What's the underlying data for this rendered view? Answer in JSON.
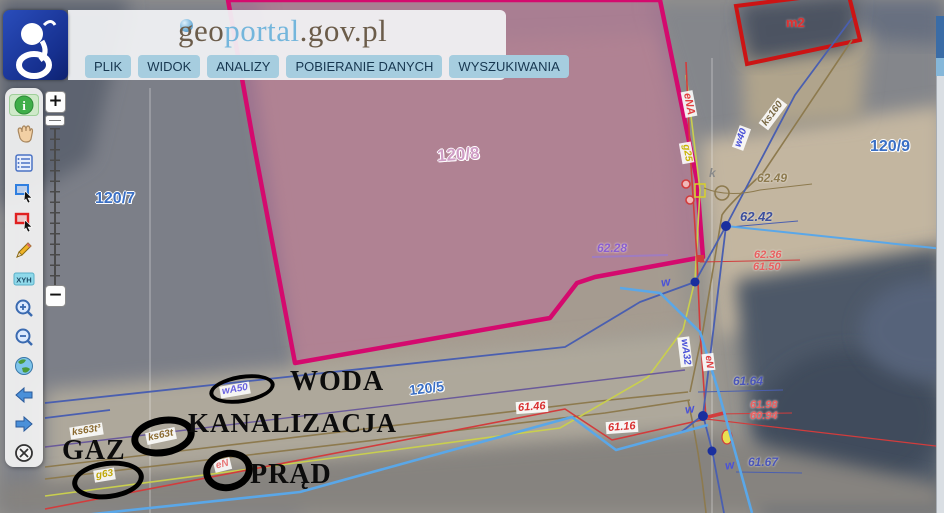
{
  "header": {
    "site_title": {
      "geo": "geo",
      "portal": "portal",
      "suffix": ".gov.pl"
    },
    "menu": [
      {
        "label": "PLIK"
      },
      {
        "label": "WIDOK"
      },
      {
        "label": "ANALIZY"
      },
      {
        "label": "POBIERANIE DANYCH"
      },
      {
        "label": "WYSZUKIWANIA"
      }
    ]
  },
  "toolbar": {
    "items": [
      {
        "name": "identify",
        "glyph": "i",
        "selected": true
      },
      {
        "name": "pan-hand"
      },
      {
        "name": "attributes-table"
      },
      {
        "name": "select-area-blue"
      },
      {
        "name": "select-area-red"
      },
      {
        "name": "draw-pencil"
      },
      {
        "name": "coordinates-xyh",
        "glyph": "XYH"
      },
      {
        "name": "zoom-in"
      },
      {
        "name": "zoom-out"
      },
      {
        "name": "full-extent-globe"
      },
      {
        "name": "previous-view"
      },
      {
        "name": "next-view"
      },
      {
        "name": "move-map"
      }
    ]
  },
  "zoom_control": {
    "plus": "+",
    "minus": "−"
  },
  "map": {
    "parcel_labels": {
      "p1207": "120/7",
      "p1208": "120/8",
      "p1209": "120/9",
      "p1205": "120/5"
    },
    "building_label": "m2",
    "utility_labels": {
      "wa50": "wA50",
      "ks63t3": "ks63t³",
      "ks63t": "ks63t",
      "g63": "g63",
      "en_road": "eN",
      "ena": "eNA",
      "g25": "g25",
      "w40": "w40",
      "ks160": "ks160",
      "wa32": "wA32",
      "en_riser": "eN",
      "w1": "w",
      "w2": "w",
      "w3": "w",
      "k1": "k"
    },
    "elevations": {
      "e6249": "62.49",
      "e6242": "62.42",
      "e6236": "62.36",
      "e6150": "61.50",
      "e6228": "62.28",
      "e6164": "61.64",
      "e6198": "61.98",
      "e6094": "60.94",
      "e6167": "61.67",
      "e6146": "61.46",
      "e6116": "61.16"
    },
    "annotations": {
      "woda": "WODA",
      "kanalizacja": "KANALIZACJA",
      "gaz": "GAZ",
      "prad": "PRĄD"
    },
    "colors": {
      "parcel_boundary": "#d40a6e",
      "parcel_fill": "rgba(190,100,150,0.45)",
      "water_line": "#4a5fb0",
      "water_main": "#5aa7e8",
      "sewer_line": "#8d7a4e",
      "gas_line": "#c9cf4e",
      "power_line": "#d23c3c",
      "building_outline": "#cc1414",
      "menu_button": "#a6cddf",
      "logo_blue": "#1c3f9e"
    }
  }
}
